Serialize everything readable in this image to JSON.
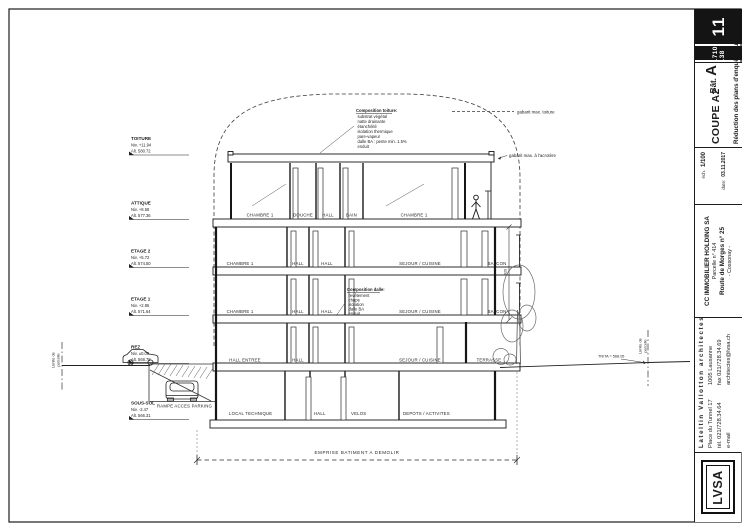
{
  "title_block": {
    "sheet_number": "11",
    "job_number": "1710-138",
    "revision_note": "Réduction des plans d'enquête du 03.11.2017",
    "drawing_title": "COUPE A2",
    "scale_label": "éch.",
    "scale_value": "1/100",
    "date_label": "date:",
    "date_value": "03.11.2017",
    "building_prefix": "Bât.",
    "building_letter": "A",
    "client_name": "CC IMMOBILIER HOLDING SA",
    "parcel": "Parcelle n° 414",
    "street": "Route de Morges n° 25",
    "city": "- Cossonay -",
    "firm_name": "Lateltin Vallotton architectes SA",
    "firm_address": "Place du Tunnel 17",
    "firm_city": "1005 Lausanne",
    "firm_tel": "tél. 021/728.34.64",
    "firm_fax": "fax 021/728.34.69",
    "firm_email_label": "e-mail",
    "firm_email": "architectes@lvsa.ch",
    "logo": "LVSA"
  },
  "levels": [
    {
      "name": "TOITURE",
      "niv": "Niv. +11.94",
      "alt": "Alt. 580.72"
    },
    {
      "name": "ATTIQUE",
      "niv": "Niv. +8.58",
      "alt": "Alt. 577.36"
    },
    {
      "name": "ETAGE 2",
      "niv": "Niv. +5.72",
      "alt": "Alt. 574.50"
    },
    {
      "name": "ETAGE 1",
      "niv": "Niv. +2.86",
      "alt": "Alt. 571.64"
    },
    {
      "name": "REZ",
      "niv": "Niv. ±0.00",
      "alt": "Alt. 568.78"
    },
    {
      "name": "SOUS-SOL",
      "niv": "Niv. -2.47",
      "alt": "Alt. 566.31"
    }
  ],
  "rooms": {
    "attique": [
      "CHAMBRE 1",
      "DOUCHE",
      "HALL",
      "BAIN",
      "CHAMBRE 1"
    ],
    "etage2": [
      "CHAMBRE 1",
      "HALL",
      "HALL",
      "SEJOUR / CUISINE",
      "BALCON"
    ],
    "etage1": [
      "CHAMBRE 1",
      "HALL",
      "HALL",
      "SEJOUR / CUISINE",
      "BALCON"
    ],
    "rez": [
      "HALL ENTREE",
      "HALL",
      "SEJOUR / CUISINE",
      "TERRASSE"
    ],
    "sous_sol": [
      "LOCAL TECHNIQUE",
      "HALL",
      "VELOS",
      "DEPOTS / ACTIVITES"
    ]
  },
  "annotations": {
    "composition_toiture": {
      "title": "Composition toiture:",
      "lines": [
        "substrat végétal",
        "natte drainante",
        "étanchéité",
        "isolation thermique",
        "pare-vapeur",
        "dalle BA : pente min. 1.5%",
        "enduit"
      ]
    },
    "composition_dalle": {
      "title": "Composition dalle:",
      "lines": [
        "revêtement",
        "chape",
        "isolation",
        "dalle BA",
        "enduit"
      ]
    },
    "gabarit_toiture": "gabarit max. toiture",
    "gabarit_acrotere": "gabarit max. à l'acrotère",
    "limite_line1": "Limite de",
    "limite_line2": "parcelle",
    "terrain_level": "TN/TA = 568.05",
    "emprise": "EMPRISE BATIMENT A DEMOLIR",
    "rampe": "RAMPE ACCES PARKING",
    "dim_height": "920"
  }
}
